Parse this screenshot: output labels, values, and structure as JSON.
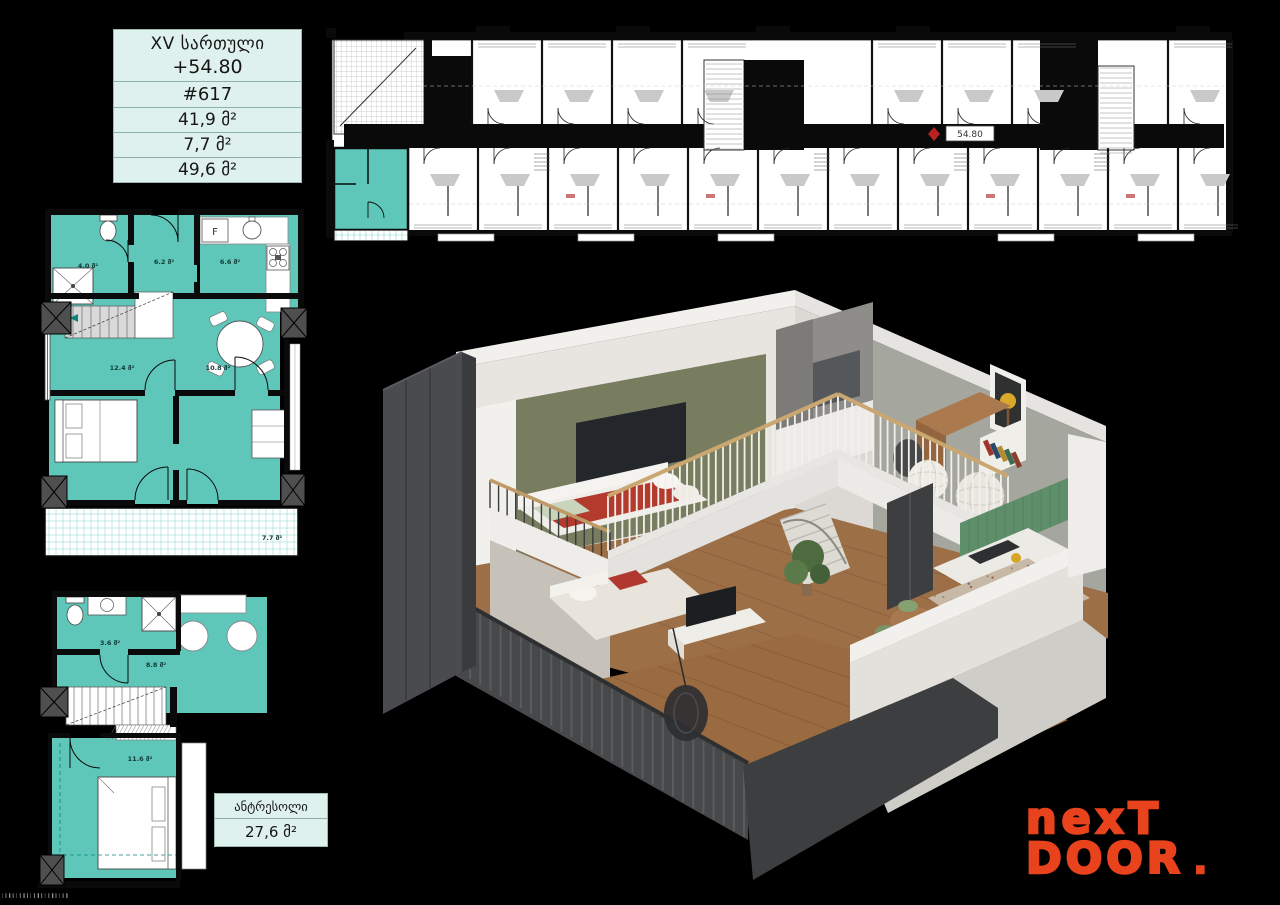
{
  "colors": {
    "teal": "#5FC7BA",
    "mint": "#DEF1ED",
    "logo_orange": "#E8431C",
    "wall_black": "#0a0a0a"
  },
  "info_table": {
    "floor": "XV სართული",
    "elevation": "+54.80",
    "apartment": "#617",
    "area_living": "41,9 მ²",
    "area_balcony": "7,7 მ²",
    "area_total": "49,6 მ²"
  },
  "floor_strip": {
    "elevation_label": "54.80"
  },
  "unit_plan": {
    "fridge": "F",
    "areas": {
      "bathroom": "4.0 მ²",
      "hall": "6.2 მ²",
      "kitchen": "6.6 მ²",
      "bedroom": "12.4 მ²",
      "living": "10.8 მ²",
      "balcony": "7.7 მ²"
    }
  },
  "mezzanine_plan": {
    "areas": {
      "bathroom": "3.6 მ²",
      "hall": "8.8 მ²",
      "bedroom": "11.6 მ²"
    }
  },
  "mezzanine_label": {
    "title": "ანტრესოლი",
    "area": "27,6 მ²"
  },
  "logo": {
    "line1": "nexT",
    "line2": "DOOR",
    "dot": "."
  },
  "fineprint": "▏▎▍▎▏▎▍▎▏▎▍▎▏▎▍▎▏▎▍"
}
